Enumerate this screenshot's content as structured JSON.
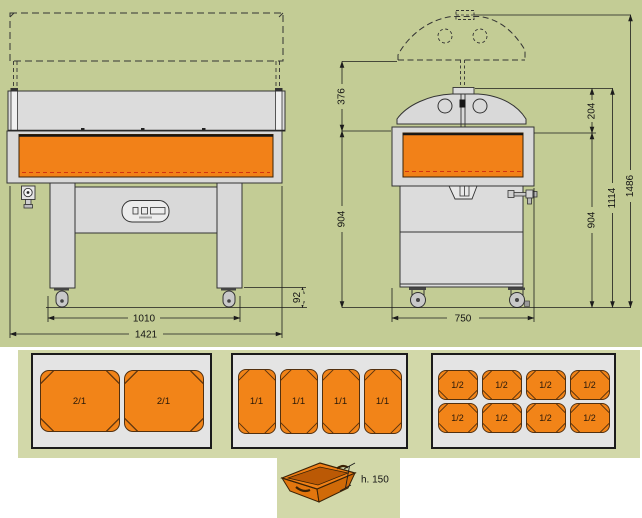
{
  "colors": {
    "background_main": "#c3cc95",
    "background_strip": "#d2d8a9",
    "structure_gray": "#d9d9d9",
    "box_gray": "#e4e4e4",
    "basin_orange": "#f28118",
    "pan_orange": "#f28418",
    "line_dark": "#2a2a2a",
    "red_dashed": "#d2350f"
  },
  "front_view": {
    "dim_caster_height": "92",
    "dim_leg_span": "1010",
    "dim_overall_width": "1421"
  },
  "side_view": {
    "dim_canopy_lift": "376",
    "dim_base_height_left": "904",
    "dim_canopy_height": "204",
    "dim_base_height_right": "904",
    "dim_closed_height": "1114",
    "dim_open_height": "1486",
    "dim_depth": "750"
  },
  "pan_configs": [
    {
      "name": "two 2/1 pans",
      "pans": [
        "2/1",
        "2/1"
      ]
    },
    {
      "name": "four 1/1 pans",
      "pans": [
        "1/1",
        "1/1",
        "1/1",
        "1/1"
      ]
    },
    {
      "name": "eight 1/2 pans",
      "pans": [
        "1/2",
        "1/2",
        "1/2",
        "1/2",
        "1/2",
        "1/2",
        "1/2",
        "1/2"
      ]
    }
  ],
  "pan_detail": {
    "height_label": "h. 150"
  }
}
